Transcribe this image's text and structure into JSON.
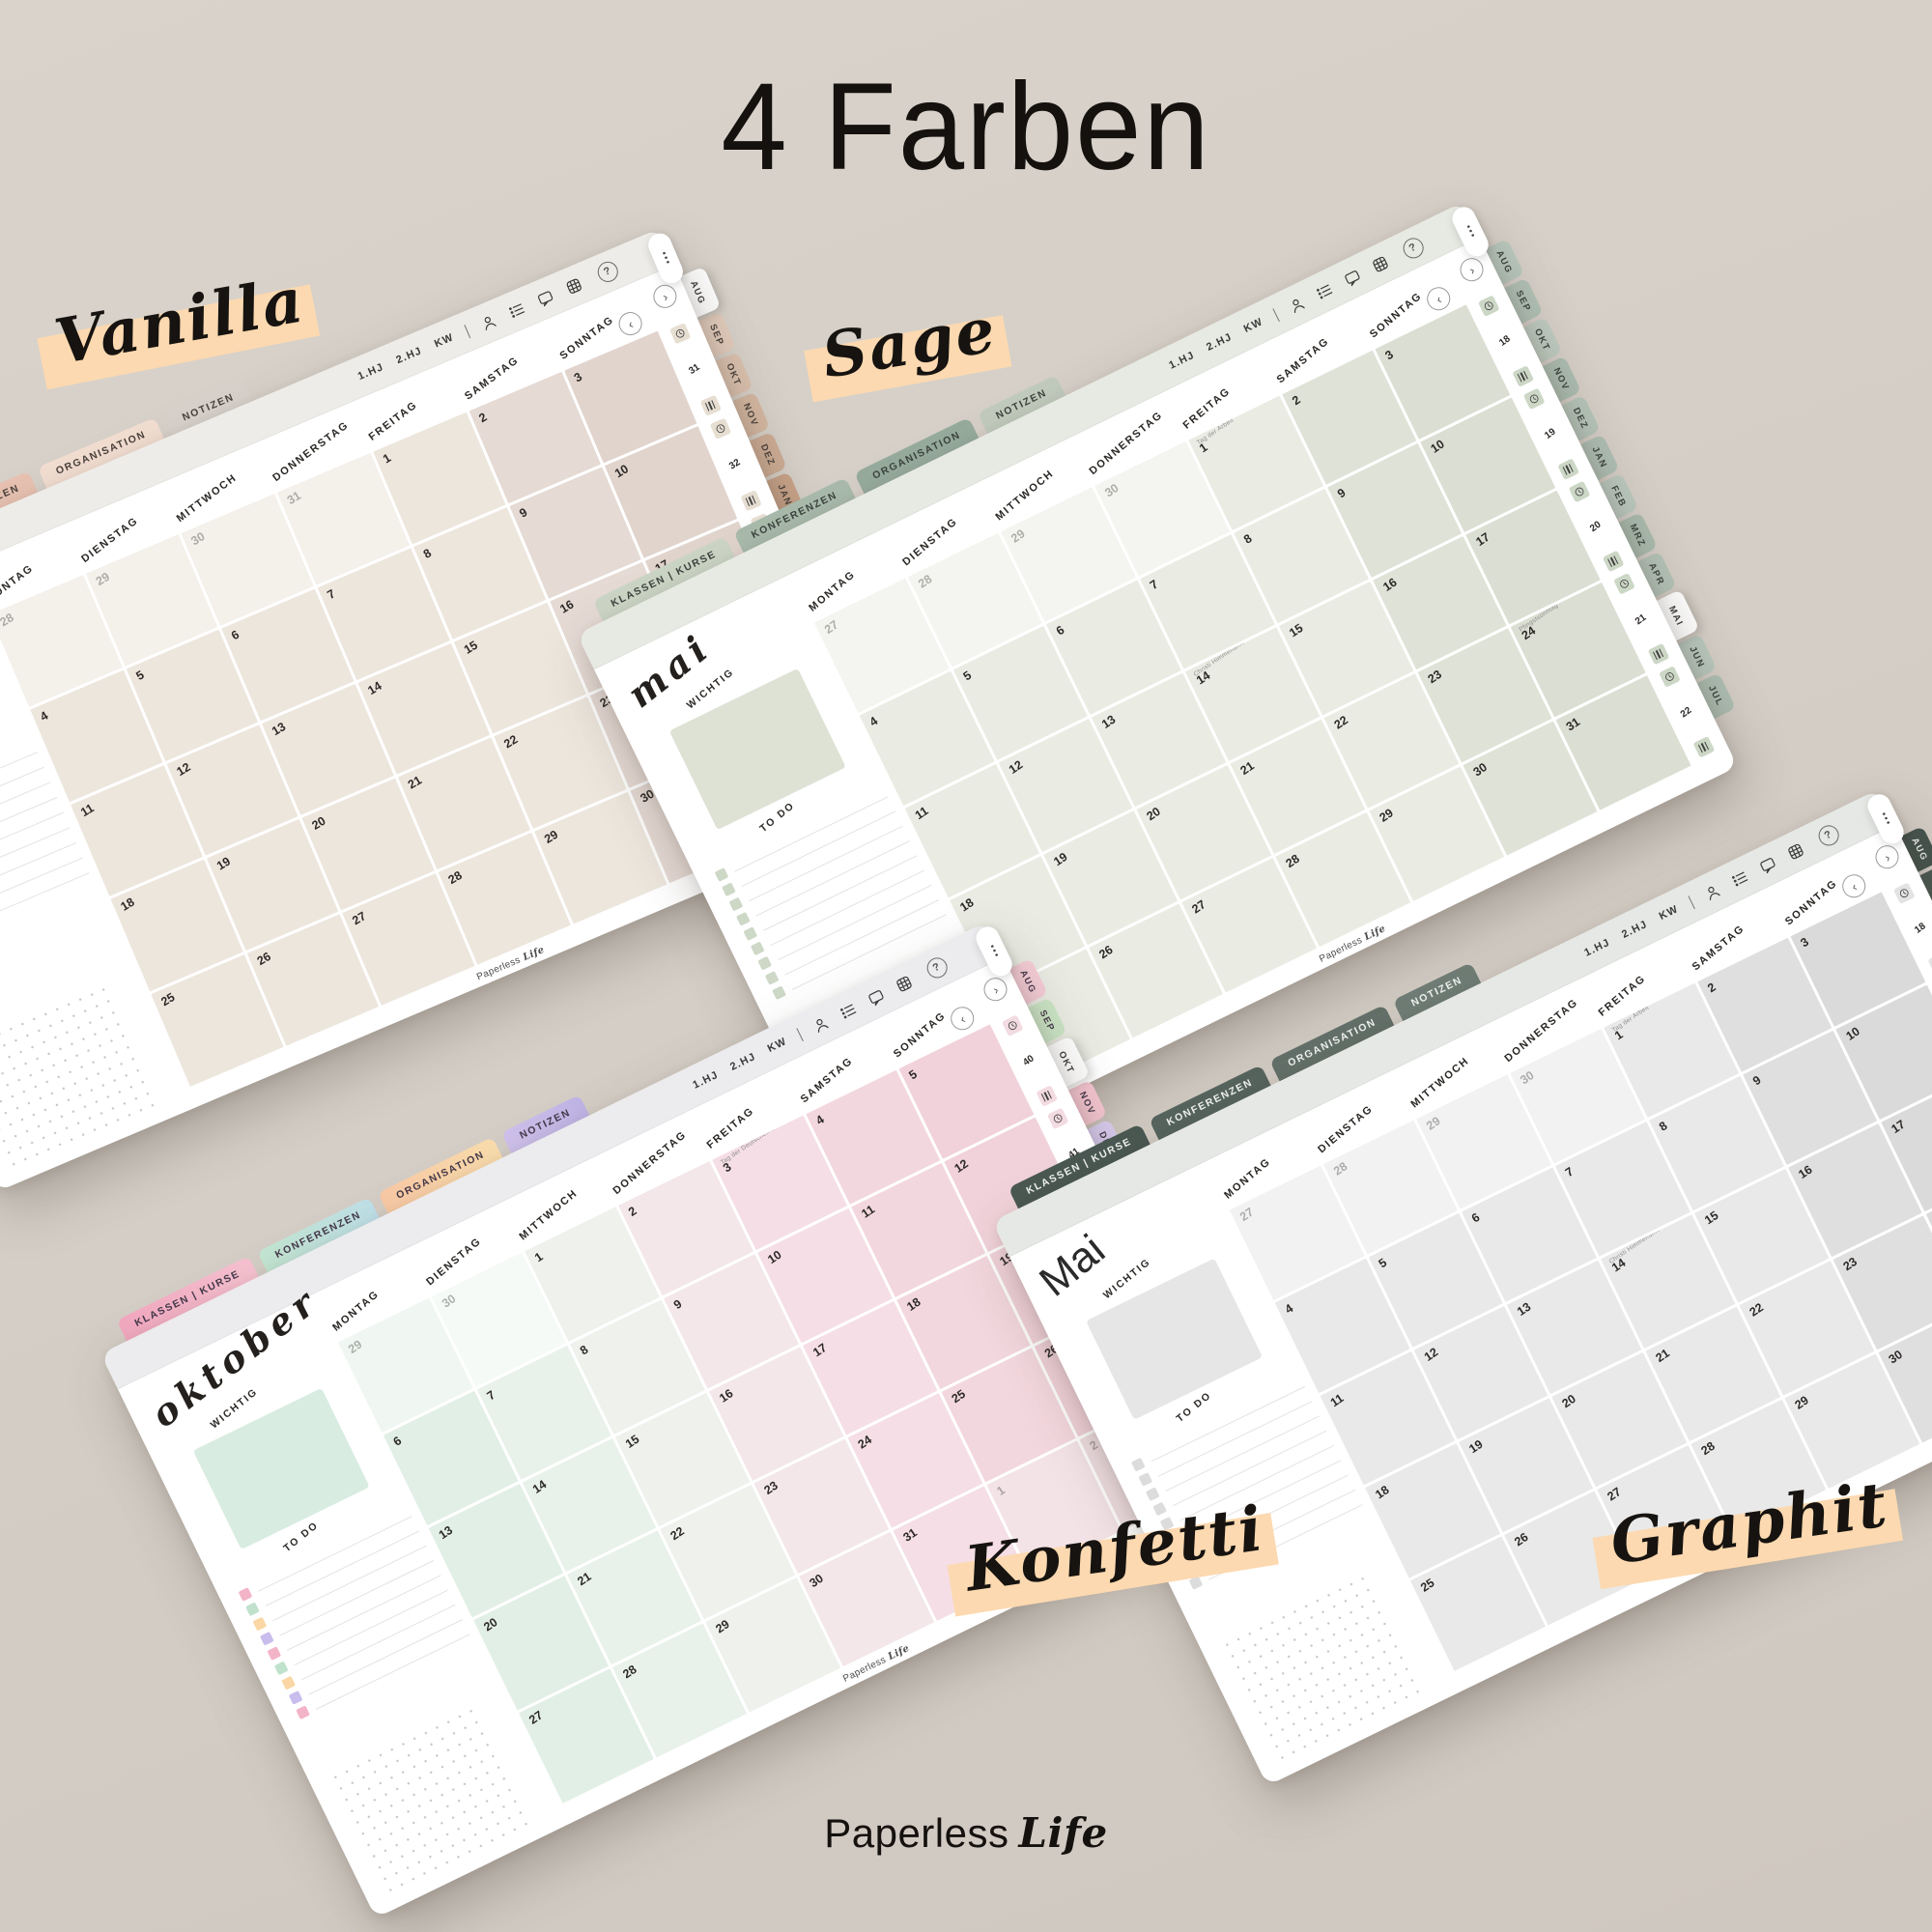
{
  "page": {
    "title": "4 Farben",
    "background_color": "#d5cec6",
    "highlight_color": "#fcd9b0",
    "logo": {
      "name": "Paperless",
      "accent": "Life"
    }
  },
  "shared": {
    "toolbar": {
      "tabs": [
        "1.HJ",
        "2.HJ",
        "KW"
      ],
      "icons": [
        "profile-icon",
        "tasklist-icon",
        "chat-icon",
        "grid-icon"
      ],
      "help_glyph": "?",
      "more_glyph": "⋯"
    },
    "nav": {
      "prev": "‹",
      "next": "›"
    },
    "top_tabs": [
      "KLASSEN | KURSE",
      "KONFERENZEN",
      "ORGANISATION",
      "NOTIZEN"
    ],
    "month_tabs": [
      "AUG",
      "SEP",
      "OKT",
      "NOV",
      "DEZ",
      "JAN",
      "FEB",
      "MRZ",
      "APR",
      "MAI",
      "JUN",
      "JUL"
    ],
    "weekdays": [
      "MONTAG",
      "DIENSTAG",
      "MITTWOCH",
      "DONNERSTAG",
      "FREITAG",
      "SAMSTAG",
      "SONNTAG"
    ],
    "sidebar": {
      "wichtig": "WICHTIG",
      "todo": "TO DO"
    },
    "todo_rows": 9,
    "watermark": {
      "name": "Paperless",
      "accent": "Life"
    }
  },
  "calendars": [
    {
      "id": "vanilla",
      "label": "Vanilla",
      "month_name": "",
      "month_style": "script",
      "active_month_tab": "AUG",
      "weeks": [
        "31",
        "32",
        "33",
        "34",
        "35"
      ],
      "rows": [
        [
          "-28",
          "-29",
          "-30",
          "-31",
          "1",
          "2",
          "3"
        ],
        [
          "4",
          "5",
          "6",
          "7",
          "8",
          "9",
          "10"
        ],
        [
          "11",
          "12",
          "13",
          "14",
          "15",
          "16",
          "17"
        ],
        [
          "18",
          "19",
          "20",
          "21",
          "22",
          "23",
          "24"
        ],
        [
          "25",
          "26",
          "27",
          "28",
          "29",
          "30",
          "31"
        ]
      ],
      "notes": {},
      "theme": {
        "toolbar_bg": "#edece8",
        "top_tabs": [
          "#dda795",
          "#e8c2b2",
          "#f3ded2",
          "#d8d2cc"
        ],
        "top_tab_text": "#4a423c",
        "cells": [
          "#ede6dd",
          "#ede6dd",
          "#ede6dd",
          "#ede6dd",
          "#ede6dd",
          "#e5dad4",
          "#e1d4cd"
        ],
        "month_tabs": [
          "#ffffff",
          "#e3ccbc",
          "#dcc2af",
          "#d5b8a2",
          "#cead95",
          "#c8a389",
          "#c29a7d",
          "#bc9171",
          "#b78967",
          "#b3815d",
          "#ae7a54",
          "#aa734c"
        ],
        "month_tab_text": "#4a423c",
        "chip": "#e7ded2",
        "wichtig_box": "#eae3da",
        "todo_checks": [
          "#ded1c3"
        ]
      }
    },
    {
      "id": "sage",
      "label": "Sage",
      "month_name": "mai",
      "month_style": "script",
      "active_month_tab": "MAI",
      "weeks": [
        "18",
        "19",
        "20",
        "21",
        "22"
      ],
      "rows": [
        [
          "-27",
          "-28",
          "-29",
          "-30",
          "1",
          "2",
          "3"
        ],
        [
          "4",
          "5",
          "6",
          "7",
          "8",
          "9",
          "10"
        ],
        [
          "11",
          "12",
          "13",
          "14",
          "15",
          "16",
          "17"
        ],
        [
          "18",
          "19",
          "20",
          "21",
          "22",
          "23",
          "24"
        ],
        [
          "25",
          "26",
          "27",
          "28",
          "29",
          "30",
          "31"
        ]
      ],
      "notes": {
        "1": "Tag der Arbeit",
        "14": "Christi Himmelfahrt",
        "24": "Pfingstsonntag"
      },
      "theme": {
        "toolbar_bg": "#e7eae3",
        "top_tabs": [
          "#ccd6c6",
          "#a9bbac",
          "#97ac9d",
          "#c2ccbe"
        ],
        "top_tab_text": "#3c443e",
        "cells": [
          "#eaece3",
          "#eaece3",
          "#eaece3",
          "#eaece3",
          "#eaece3",
          "#dfe2d7",
          "#dbded2"
        ],
        "month_tabs": [
          "#bac9be",
          "#b2c2b6",
          "#bfccc1",
          "#adbeb1",
          "#b7c6ba",
          "#b0c0b4",
          "#bccabf",
          "#aabcae",
          "#b5c4b8",
          "#ffffff",
          "#b9c8bd",
          "#aebfb2"
        ],
        "month_tab_text": "#3c443e",
        "chip": "#ccd7c6",
        "wichtig_box": "#dee2d5",
        "todo_checks": [
          "#cdd8c7"
        ]
      }
    },
    {
      "id": "konfetti",
      "label": "Konfetti",
      "month_name": "oktober",
      "month_style": "script",
      "active_month_tab": "OKT",
      "weeks": [
        "40",
        "41",
        "42",
        "43",
        "44"
      ],
      "rows": [
        [
          "-29",
          "-30",
          "1",
          "2",
          "3",
          "4",
          "5"
        ],
        [
          "6",
          "7",
          "8",
          "9",
          "10",
          "11",
          "12"
        ],
        [
          "13",
          "14",
          "15",
          "16",
          "17",
          "18",
          "19"
        ],
        [
          "20",
          "21",
          "22",
          "23",
          "24",
          "25",
          "26"
        ],
        [
          "27",
          "28",
          "29",
          "30",
          "31",
          "-1",
          "-2"
        ]
      ],
      "notes": {
        "3": "Tag der Deutschen Einheit"
      },
      "theme": {
        "toolbar_bg": "#ecebee",
        "top_tabs": [
          "linear-gradient(100deg,#f2a8c0,#f7c3d2)",
          "linear-gradient(100deg,#c3e5d0,#bfe0ea)",
          "linear-gradient(100deg,#f9c9a5,#fbdfae)",
          "linear-gradient(100deg,#cfc2ec,#bfb4e6)"
        ],
        "top_tab_text": "#45394a",
        "cells": [
          "#e2efe6",
          "#e8f2ea",
          "#eef1ec",
          "#f3e7ea",
          "#f5dee5",
          "#f3d7de",
          "#f1d2da"
        ],
        "month_tabs": [
          "#f7ced8",
          "#cde7c7",
          "#ffffff",
          "#f6c6d1",
          "#d9cdf1",
          "#fad2a5",
          "#beb1e8",
          "#f2abbc",
          "#aedcc5",
          "#f9e6ac",
          "#bbd8ef",
          "#f5edba"
        ],
        "month_tab_text": "#45394a",
        "chip": "#f3dbe2",
        "wichtig_box": "#d9ece1",
        "todo_checks": [
          "#f3b4c8",
          "#c0e2cc",
          "#fad7a4",
          "#c8bdec"
        ]
      }
    },
    {
      "id": "graphit",
      "label": "Graphit",
      "month_name": "Mai",
      "month_style": "plain",
      "active_month_tab": "MAI",
      "weeks": [
        "18",
        "19",
        "20",
        "21",
        "22"
      ],
      "rows": [
        [
          "-27",
          "-28",
          "-29",
          "-30",
          "1",
          "2",
          "3"
        ],
        [
          "4",
          "5",
          "6",
          "7",
          "8",
          "9",
          "10"
        ],
        [
          "11",
          "12",
          "13",
          "14",
          "15",
          "16",
          "17"
        ],
        [
          "18",
          "19",
          "20",
          "21",
          "22",
          "23",
          "24"
        ],
        [
          "25",
          "26",
          "27",
          "28",
          "29",
          "30",
          "31"
        ]
      ],
      "notes": {
        "1": "Tag der Arbeit",
        "14": "Christi Himmelfahrt",
        "24": "Pfingstsonntag"
      },
      "theme": {
        "toolbar_bg": "#e5e8e4",
        "top_tabs": [
          "#4a5852",
          "#56645e",
          "#637069",
          "#6f7d76"
        ],
        "top_tab_text": "#f1f3f1",
        "cells": [
          "#e9e9e9",
          "#e9e9e9",
          "#e9e9e9",
          "#e9e9e9",
          "#e9e9e9",
          "#dfdfdf",
          "#dadada"
        ],
        "month_tabs": [
          "#45534d",
          "#4b5953",
          "#515f59",
          "#57655f",
          "#5d6b65",
          "#63716b",
          "#697771",
          "#6f7d77",
          "#75837d",
          "#ffffff",
          "#7b8983",
          "#818f89"
        ],
        "month_tab_text": "#eef0ee",
        "chip": "#e3e3e3",
        "wichtig_box": "#e6e6e6",
        "todo_checks": [
          "#dcdcdc"
        ]
      }
    }
  ]
}
